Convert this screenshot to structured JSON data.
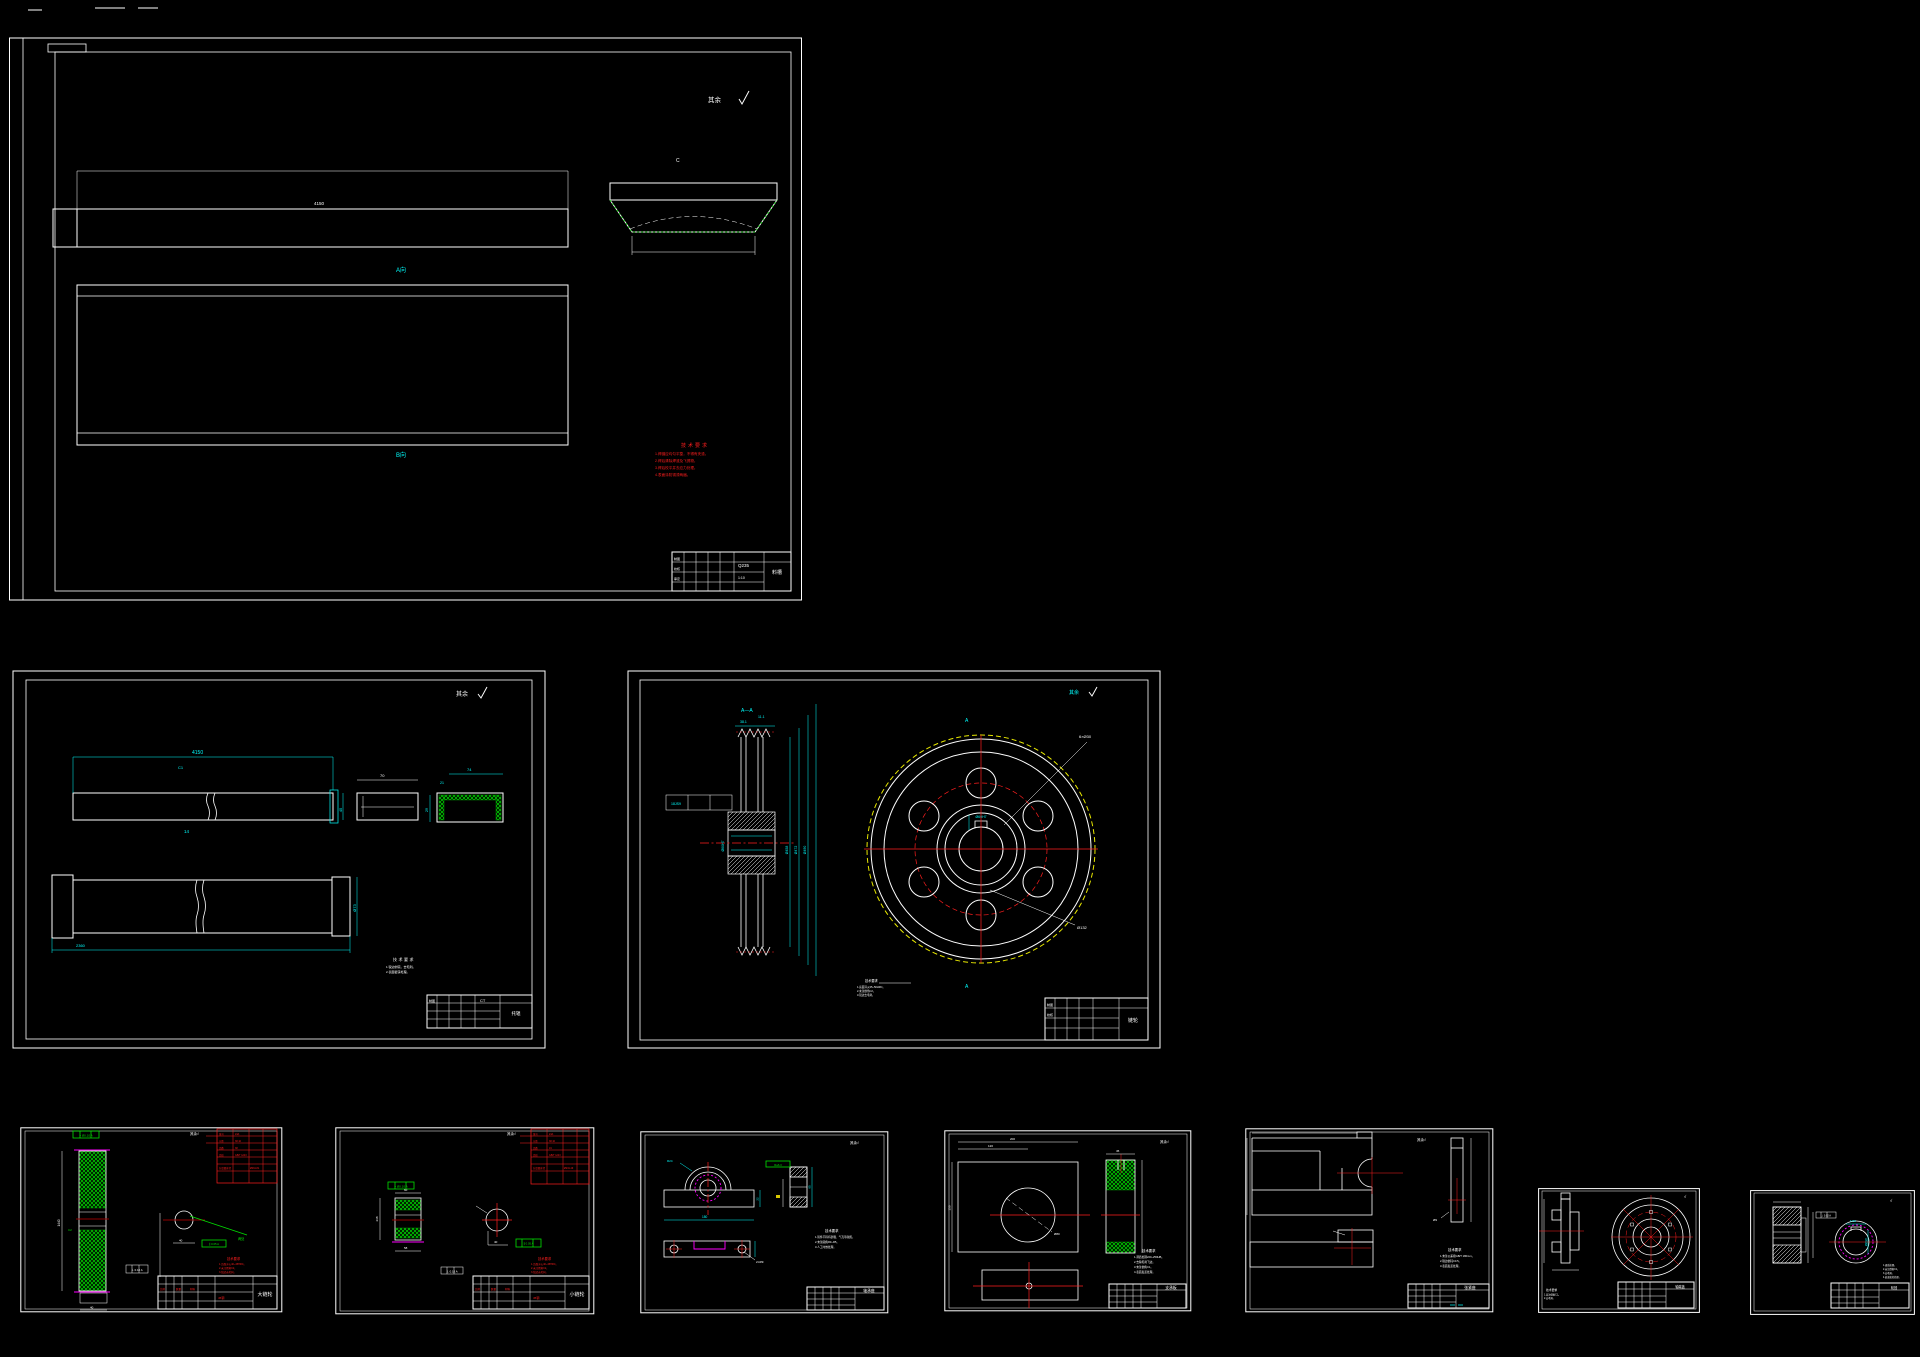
{
  "canvas": {
    "w": 1920,
    "h": 1357,
    "bg": "#000000"
  },
  "palette": {
    "line": "#ffffff",
    "dim": "#00ffff",
    "hatch": "#00c800",
    "annot": "#ff1e1e",
    "centerline": "#8f0000",
    "magenta": "#ff00ff",
    "pitch_circle": "#e8e800"
  },
  "common": {
    "roughness": "其余",
    "check": "√",
    "rough_full": "其余√",
    "tech_title": "技术要求"
  },
  "s1": {
    "part": "料槽",
    "material": "Q235",
    "view_top": "A向",
    "view_bottom": "B向",
    "detail": "C",
    "dim_top": "4150",
    "tech_lines": [
      "1.焊缝应均匀平整，不得有夹渣。",
      "2.焊后清除焊渣及飞溅物。",
      "3.焊后校平并去应力处理。",
      "4.表面涂防锈漆两遍。"
    ],
    "tb": {
      "f1": "制图",
      "f2": "校核",
      "f3": "审定",
      "scale": "1:10"
    }
  },
  "s2": {
    "part": "托辊",
    "dim_len": "4150",
    "dim_h": "45",
    "dim_t": "14",
    "dim_w": "70",
    "dim_cw": "74",
    "dim_cf": "21",
    "dim_ch": "29",
    "dim_d": "Ø73",
    "dim_len2": "2360",
    "mark": "C1",
    "tech_lines": [
      "1.锐边倒钝，去毛刺。",
      "2.表面镀锌处理。"
    ],
    "tb": {
      "f1": "制图",
      "code": "CT"
    }
  },
  "s3": {
    "part": "链轮",
    "section": "A—A",
    "sec_mark": "A",
    "dim1": "38.1",
    "dim2": "11.1",
    "d1": "Ø458",
    "d2": "Ø472",
    "d3": "Ø490",
    "bore": "Ø60H7",
    "key": "18JS9",
    "holes": "6×Ø30",
    "hub": "Ø132",
    "tech_lines": [
      "1.齿面淬火45~50HRC。",
      "2.未注倒角C2。",
      "3.锐边去毛刺。"
    ],
    "tb": {
      "f1": "制图",
      "f2": "校核"
    }
  },
  "s4": {
    "part": "大链轮",
    "frame1": "⌖ Ø0.10 A",
    "frame2": "∥ 0.05 A",
    "frame3": "⊥ 0.10 A",
    "note_green": "两处",
    "dim_l": "1440",
    "dim_m": "40",
    "dim_b": "40",
    "chamfer": "C2",
    "table": [
      "链号",
      "24A",
      "节距",
      "38.10",
      "齿数",
      "38",
      "齿形",
      "GB/T 1243",
      "分度圆直径",
      "Ø461.81"
    ],
    "tech_lines": [
      "1.齿面淬火40~45HRC。",
      "2.未注倒角C2。",
      "3.锐边去毛刺。"
    ],
    "tb_red": [
      "比例",
      "数量",
      "材料"
    ],
    "tb_mid": "45钢"
  },
  "s5": {
    "part": "小链轮",
    "frame1": "⌖ Ø0.10 A",
    "frame2": "∥ 0.05 A",
    "frame3": "⊥ 0.10 A",
    "dim_t": "60",
    "dim_b": "58",
    "dim_l": "238",
    "dim_m": "40",
    "table": [
      "链号",
      "24A",
      "节距",
      "38.10",
      "齿数",
      "19",
      "齿形",
      "GB/T 1243",
      "分度圆直径",
      "Ø231.49"
    ],
    "tech_lines": [
      "1.齿面淬火40~45HRC。",
      "2.未注倒角C2。",
      "3.锐边去毛刺。"
    ],
    "tb_red": [
      "比例",
      "数量",
      "材料"
    ],
    "tb_mid": "45钢"
  },
  "s6": {
    "part": "轴承座",
    "frame_green": "Ra6.3",
    "dim_base": "180",
    "dim_r": "R24",
    "dim_h": "65",
    "dim_s": "22",
    "holes": "2×Ø9",
    "tech_lines": [
      "1.铸件不得有砂眼、气孔等缺陷。",
      "2.未注圆角R3~R5。",
      "3.人工时效处理。"
    ]
  },
  "s7": {
    "part": "支承板",
    "dim_w": "200",
    "dim_c": "120",
    "dim_hole": "Ø80",
    "dim_hgt": "150",
    "dim_t": "45",
    "tech_lines": [
      "1.调质处理220~250HB。",
      "2.去除毛刺飞边。",
      "3.未注倒角C1。",
      "4.表面发蓝处理。"
    ]
  },
  "s8": {
    "part": "张紧座",
    "hole": "Ø9",
    "tech_lines": [
      "1.未注公差按GB/T 1804-m。",
      "2.锐边倒钝C0.5。",
      "3.表面发蓝处理。"
    ]
  },
  "s9": {
    "part": "轴端盖",
    "tech_lines": [
      "1.未注倒角C1。",
      "2.去毛刺。"
    ]
  },
  "s10": {
    "part": "轮毂",
    "frame": "⊥ 0.02 A",
    "bore": "Ø20H7",
    "key": "6JS9",
    "tech_lines": [
      "1.调质处理。",
      "2.未注倒角C1。",
      "3.去毛刺。",
      "4.表面氧化处理。"
    ]
  }
}
